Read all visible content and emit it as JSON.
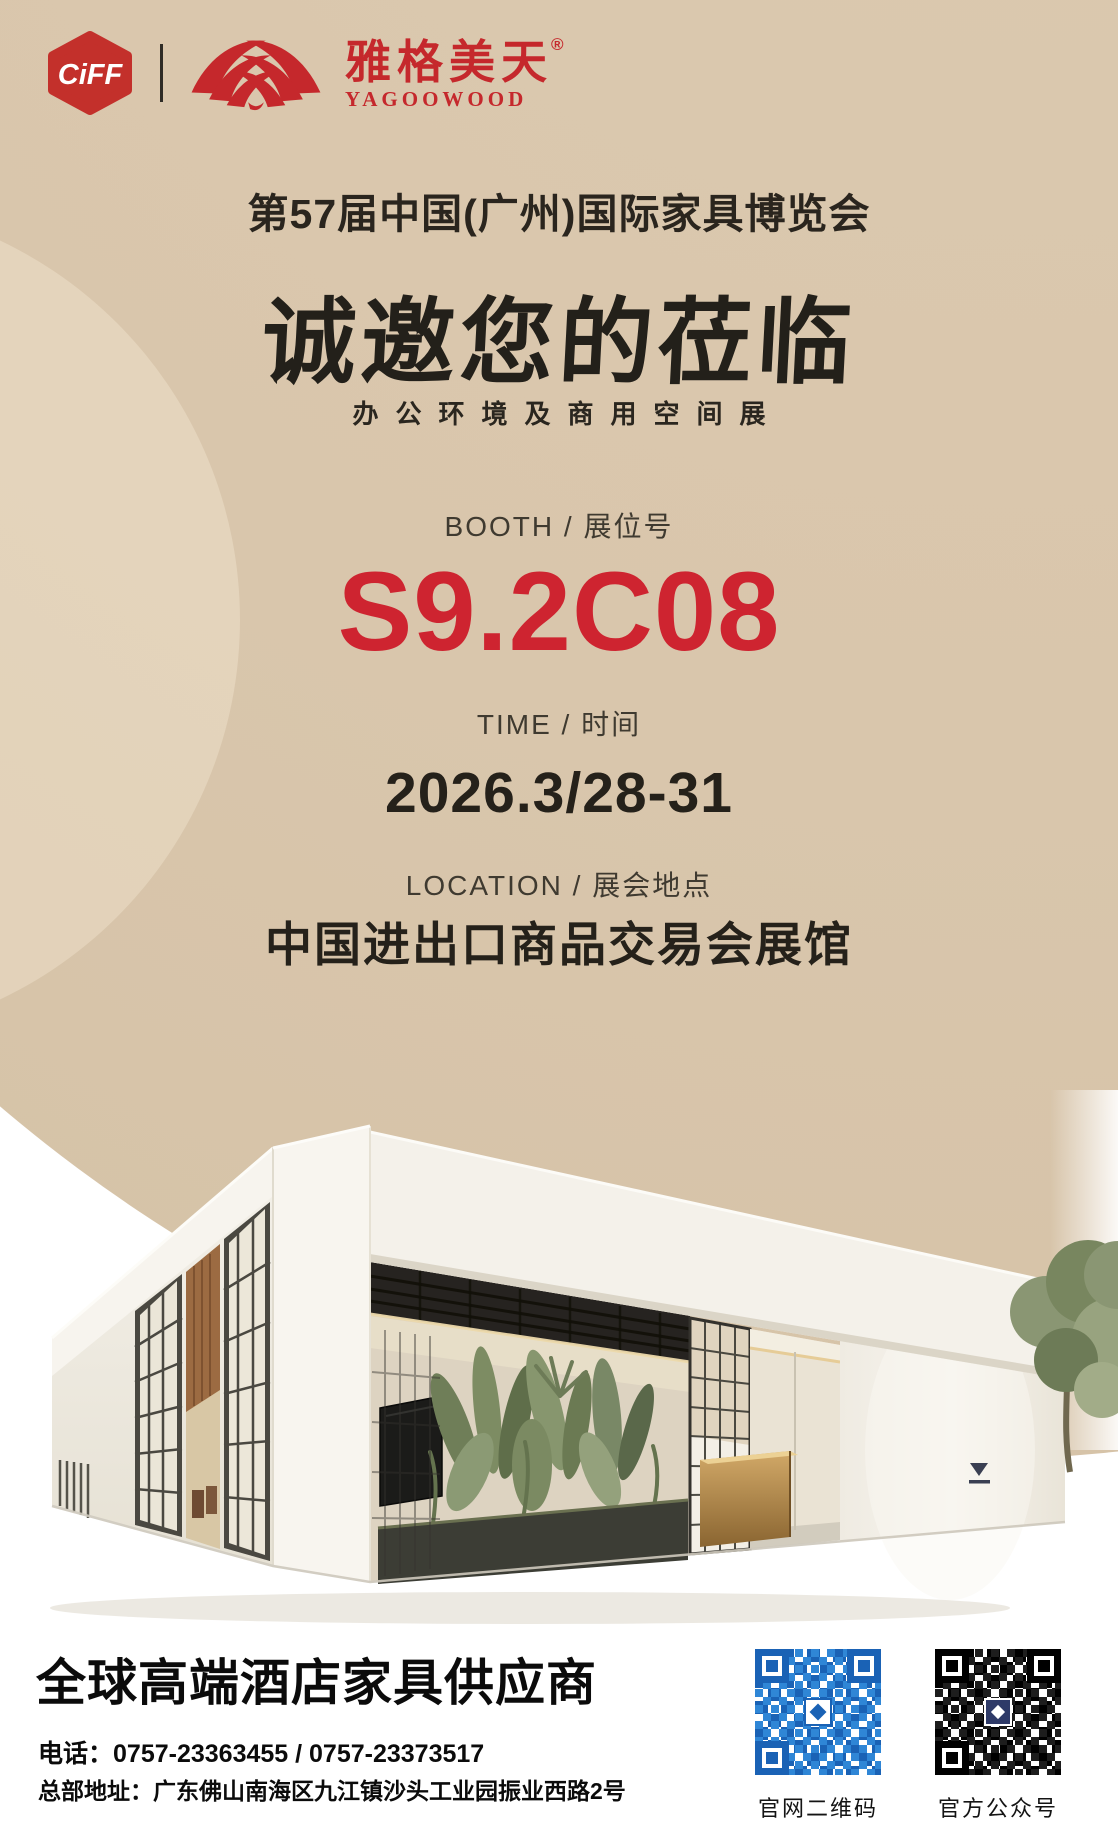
{
  "colors": {
    "background_beige": "#d9c6ac",
    "accent_red": "#c5282c",
    "booth_red": "#ce2430",
    "ink": "#25211a",
    "footer_black": "#0b0b0b",
    "qr_blue": "#2f86d6",
    "qr_black": "#1d1d1d"
  },
  "header": {
    "ciff_text": "CiFF",
    "brand_cn": "雅格美天",
    "brand_reg": "®",
    "brand_en": "YAGOOWOOD"
  },
  "event": {
    "title": "第57届中国(广州)国际家具博览会",
    "headline": "诚邀您的莅临",
    "subtitle": "办公环境及商用空间展"
  },
  "booth": {
    "label": "BOOTH / 展位号",
    "number": "S9.2C08"
  },
  "time": {
    "label": "TIME / 时间",
    "value": "2026.3/28-31"
  },
  "location": {
    "label": "LOCATION / 展会地点",
    "venue": "中国进出口商品交易会展馆"
  },
  "footer": {
    "tagline": "全球高端酒店家具供应商",
    "phone_label": "电话：",
    "phone_value": "0757-23363455 / 0757-23373517",
    "address_label": "总部地址：",
    "address_value": "广东佛山南海区九江镇沙头工业园振业西路2号",
    "qr_website_label": "官网二维码",
    "qr_wechat_label": "官方公众号"
  }
}
